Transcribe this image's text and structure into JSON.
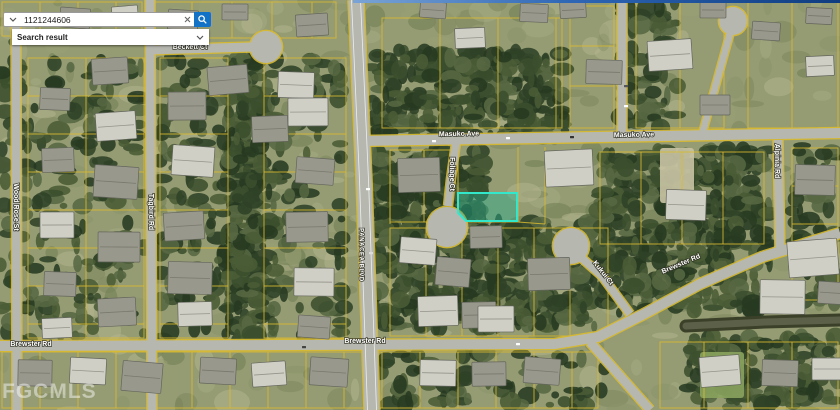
{
  "search": {
    "value": "1121244606",
    "result_label": "Search result",
    "button_color": "#1273c6"
  },
  "map": {
    "watermark": {
      "text": "FGCMLS",
      "x": 2,
      "y": 398,
      "size": 21
    },
    "colors": {
      "ground": "#959c73",
      "road": "#b6b8b0",
      "parcel_line": "#d9ba30",
      "highlight_fill": "rgba(34,178,148,0.42)",
      "highlight_stroke": "#33e8ca",
      "canal": "#3b4029",
      "canal_water": "#5d6048",
      "label_fill": "#ffffff",
      "label_halo": "rgba(45,45,32,0.85)"
    },
    "labels": [
      {
        "text": "Beckett Ct",
        "x": 190,
        "y": 47,
        "rot": 0
      },
      {
        "text": "Masuko Ave",
        "x": 459,
        "y": 134,
        "rot": -1
      },
      {
        "text": "Masuko Ave",
        "x": 634,
        "y": 135,
        "rot": -1
      },
      {
        "text": "Foliage Ct",
        "x": 452,
        "y": 174,
        "rot": 90
      },
      {
        "text": "Alpinia Rd",
        "x": 777,
        "y": 161,
        "rot": 90
      },
      {
        "text": "PANACEA BLVD",
        "x": 361,
        "y": 255,
        "rot": 90,
        "size": 6,
        "spacing": 0.6
      },
      {
        "text": "Wood Rose St",
        "x": 16,
        "y": 207,
        "rot": 90
      },
      {
        "text": "Tagbird Rd",
        "x": 151,
        "y": 212,
        "rot": 90
      },
      {
        "text": "Kukui Ct",
        "x": 603,
        "y": 273,
        "rot": 52
      },
      {
        "text": "Brewster Rd",
        "x": 31,
        "y": 344,
        "rot": 0
      },
      {
        "text": "Brewster Rd",
        "x": 365,
        "y": 341,
        "rot": 0
      },
      {
        "text": "Brewster Rd",
        "x": 681,
        "y": 264,
        "rot": -23
      }
    ],
    "highlight_parcel": {
      "points": "458,193 517,193 517,221 466,221 458,213"
    },
    "roads": [
      {
        "name": "panacea-blvd",
        "pts": [
          [
            356,
            0
          ],
          [
            364,
            180
          ],
          [
            372,
            410
          ]
        ],
        "w": 15,
        "stripes": true
      },
      {
        "name": "masuko-ave",
        "pts": [
          [
            360,
            141
          ],
          [
            840,
            133
          ]
        ],
        "w": 10
      },
      {
        "name": "beckett-ct",
        "pts": [
          [
            148,
            50
          ],
          [
            252,
            47
          ]
        ],
        "w": 9
      },
      {
        "name": "wood-rose-st",
        "pts": [
          [
            16,
            24
          ],
          [
            17,
            410
          ]
        ],
        "w": 9
      },
      {
        "name": "tagbird-rd",
        "pts": [
          [
            150,
            0
          ],
          [
            152,
            410
          ]
        ],
        "w": 9
      },
      {
        "name": "brewster-rd",
        "pts": [
          [
            0,
            346
          ],
          [
            555,
            344
          ],
          [
            598,
            337
          ],
          [
            642,
            315
          ],
          [
            700,
            284
          ],
          [
            762,
            257
          ],
          [
            840,
            233
          ]
        ],
        "w": 10
      },
      {
        "name": "brewster-south-leg",
        "pts": [
          [
            590,
            342
          ],
          [
            650,
            410
          ]
        ],
        "w": 9
      },
      {
        "name": "foliage-ct",
        "pts": [
          [
            456,
            143
          ],
          [
            451,
            178
          ],
          [
            448,
            206
          ]
        ],
        "w": 8
      },
      {
        "name": "kukui-ct",
        "pts": [
          [
            576,
            253
          ],
          [
            602,
            276
          ],
          [
            630,
            314
          ]
        ],
        "w": 8
      },
      {
        "name": "alpinia-rd",
        "pts": [
          [
            778,
            140
          ],
          [
            780,
            250
          ]
        ],
        "w": 9
      },
      {
        "name": "north-stub-rd",
        "pts": [
          [
            622,
            0
          ],
          [
            622,
            137
          ]
        ],
        "w": 9
      },
      {
        "name": "top-right-court",
        "pts": [
          [
            731,
            30
          ],
          [
            703,
            131
          ]
        ],
        "w": 7
      }
    ],
    "culdesacs": [
      {
        "x": 266,
        "y": 47,
        "r": 16
      },
      {
        "x": 447,
        "y": 227,
        "r": 20
      },
      {
        "x": 571,
        "y": 246,
        "r": 18
      },
      {
        "x": 733,
        "y": 21,
        "r": 14
      }
    ],
    "blocks": [
      {
        "x": 28,
        "y": 58,
        "w": 116,
        "h": 280,
        "dir": "h",
        "gap": 38,
        "mid": 1
      },
      {
        "x": 160,
        "y": 58,
        "w": 68,
        "h": 280,
        "dir": "h",
        "gap": 38
      },
      {
        "x": 264,
        "y": 58,
        "w": 82,
        "h": 280,
        "dir": "h",
        "gap": 38
      },
      {
        "x": 2,
        "y": 2,
        "w": 140,
        "h": 34,
        "dir": "v",
        "gap": 38
      },
      {
        "x": 152,
        "y": 2,
        "w": 184,
        "h": 36,
        "dir": "v",
        "gap": 40
      },
      {
        "x": 382,
        "y": 18,
        "w": 180,
        "h": 110,
        "dir": "v",
        "gap": 58
      },
      {
        "x": 570,
        "y": 6,
        "w": 44,
        "h": 122,
        "dir": "h",
        "gap": 40
      },
      {
        "x": 636,
        "y": 2,
        "w": 88,
        "h": 126,
        "dir": "v",
        "gap": 44
      },
      {
        "x": 748,
        "y": 2,
        "w": 90,
        "h": 126,
        "dir": "v",
        "gap": 44
      },
      {
        "x": 390,
        "y": 150,
        "w": 68,
        "h": 72,
        "dir": "v",
        "gap": 34
      },
      {
        "x": 600,
        "y": 152,
        "w": 164,
        "h": 92,
        "dir": "v",
        "gap": 41
      },
      {
        "x": 792,
        "y": 148,
        "w": 46,
        "h": 152,
        "dir": "h",
        "gap": 38
      },
      {
        "x": 390,
        "y": 228,
        "w": 218,
        "h": 108,
        "dir": "v",
        "gap": 36
      },
      {
        "x": 2,
        "y": 352,
        "w": 596,
        "h": 56,
        "dir": "v",
        "gap": 38
      },
      {
        "x": 660,
        "y": 342,
        "w": 178,
        "h": 66,
        "dir": "v",
        "gap": 44
      }
    ],
    "extra_lines": [
      [
        458,
        150,
        458,
        193
      ],
      [
        518,
        147,
        518,
        222
      ],
      [
        545,
        147,
        545,
        224
      ],
      [
        458,
        193,
        518,
        193
      ],
      [
        466,
        222,
        518,
        222
      ],
      [
        518,
        222,
        545,
        224
      ],
      [
        390,
        150,
        390,
        224
      ],
      [
        424,
        150,
        424,
        200
      ]
    ],
    "forest_zones": [
      {
        "x": 370,
        "y": 50,
        "w": 195,
        "h": 88,
        "d": 1
      },
      {
        "x": 228,
        "y": 56,
        "w": 36,
        "h": 286,
        "d": 1.5
      },
      {
        "x": 368,
        "y": 148,
        "w": 115,
        "h": 180,
        "d": 1
      },
      {
        "x": 480,
        "y": 222,
        "w": 115,
        "h": 105,
        "d": 1
      },
      {
        "x": 600,
        "y": 148,
        "w": 170,
        "h": 165,
        "d": 0.9
      },
      {
        "x": 688,
        "y": 336,
        "w": 150,
        "h": 72,
        "d": 0.8
      },
      {
        "x": 30,
        "y": 58,
        "w": 115,
        "h": 282,
        "d": 0.25
      },
      {
        "x": 160,
        "y": 58,
        "w": 68,
        "h": 282,
        "d": 0.3
      },
      {
        "x": 264,
        "y": 58,
        "w": 80,
        "h": 282,
        "d": 0.3
      },
      {
        "x": 380,
        "y": 352,
        "w": 225,
        "h": 56,
        "d": 0.3
      },
      {
        "x": 620,
        "y": 2,
        "w": 60,
        "h": 128,
        "d": 0.5
      },
      {
        "x": 790,
        "y": 145,
        "w": 50,
        "h": 158,
        "d": 0.4
      },
      {
        "x": 0,
        "y": 40,
        "w": 28,
        "h": 300,
        "d": 0.35
      }
    ],
    "light_patches": [
      {
        "x": 660,
        "y": 148,
        "w": 34,
        "h": 55,
        "c": "#c9c4a4"
      },
      {
        "x": 700,
        "y": 352,
        "w": 44,
        "h": 46,
        "c": "#8aa35e"
      }
    ],
    "canal_br": [
      [
        686,
        326
      ],
      [
        765,
        322
      ],
      [
        840,
        320
      ]
    ],
    "houses": [
      [
        60,
        8,
        30,
        20,
        0
      ],
      [
        112,
        6,
        26,
        17,
        1
      ],
      [
        168,
        10,
        30,
        20,
        0
      ],
      [
        222,
        4,
        26,
        16,
        0
      ],
      [
        296,
        14,
        32,
        22,
        0
      ],
      [
        420,
        2,
        26,
        16,
        0
      ],
      [
        455,
        28,
        30,
        20,
        1
      ],
      [
        520,
        4,
        28,
        18,
        0
      ],
      [
        560,
        2,
        26,
        16,
        0
      ],
      [
        648,
        40,
        44,
        30,
        1
      ],
      [
        700,
        2,
        26,
        16,
        0
      ],
      [
        752,
        22,
        28,
        18,
        0
      ],
      [
        806,
        8,
        26,
        16,
        0
      ],
      [
        806,
        56,
        28,
        20,
        1
      ],
      [
        92,
        58,
        36,
        26,
        0
      ],
      [
        40,
        88,
        30,
        22,
        0
      ],
      [
        96,
        112,
        40,
        28,
        1
      ],
      [
        42,
        148,
        32,
        24,
        0
      ],
      [
        94,
        166,
        44,
        32,
        0
      ],
      [
        40,
        212,
        34,
        26,
        1
      ],
      [
        98,
        232,
        42,
        30,
        0
      ],
      [
        44,
        272,
        32,
        24,
        0
      ],
      [
        98,
        298,
        38,
        28,
        0
      ],
      [
        42,
        318,
        30,
        20,
        1
      ],
      [
        168,
        92,
        38,
        28,
        0
      ],
      [
        172,
        146,
        42,
        30,
        1
      ],
      [
        164,
        212,
        40,
        28,
        0
      ],
      [
        168,
        262,
        44,
        32,
        0
      ],
      [
        178,
        302,
        34,
        24,
        1
      ],
      [
        208,
        66,
        40,
        28,
        0
      ],
      [
        278,
        72,
        36,
        26,
        1
      ],
      [
        252,
        116,
        36,
        26,
        0
      ],
      [
        288,
        98,
        40,
        28,
        1
      ],
      [
        296,
        158,
        38,
        26,
        0
      ],
      [
        286,
        212,
        42,
        30,
        0
      ],
      [
        294,
        268,
        40,
        28,
        1
      ],
      [
        298,
        316,
        32,
        22,
        0
      ],
      [
        398,
        158,
        42,
        34,
        0
      ],
      [
        400,
        238,
        36,
        26,
        1
      ],
      [
        470,
        226,
        32,
        22,
        0
      ],
      [
        436,
        258,
        34,
        28,
        0
      ],
      [
        418,
        296,
        40,
        30,
        1
      ],
      [
        462,
        302,
        34,
        26,
        0
      ],
      [
        545,
        150,
        48,
        36,
        1
      ],
      [
        528,
        258,
        42,
        32,
        0
      ],
      [
        478,
        306,
        36,
        26,
        1
      ],
      [
        666,
        190,
        40,
        30,
        1
      ],
      [
        700,
        95,
        30,
        20,
        0
      ],
      [
        586,
        60,
        36,
        24,
        0
      ],
      [
        760,
        280,
        45,
        34,
        1
      ],
      [
        795,
        165,
        40,
        30,
        0
      ],
      [
        788,
        240,
        50,
        36,
        1
      ],
      [
        818,
        282,
        30,
        22,
        0
      ],
      [
        18,
        360,
        34,
        26,
        0
      ],
      [
        70,
        358,
        36,
        26,
        1
      ],
      [
        122,
        362,
        40,
        30,
        0
      ],
      [
        200,
        358,
        36,
        26,
        0
      ],
      [
        252,
        362,
        34,
        24,
        1
      ],
      [
        310,
        358,
        38,
        28,
        0
      ],
      [
        420,
        360,
        36,
        26,
        1
      ],
      [
        472,
        362,
        34,
        24,
        0
      ],
      [
        524,
        358,
        36,
        26,
        0
      ],
      [
        700,
        356,
        40,
        30,
        1
      ],
      [
        762,
        360,
        36,
        26,
        0
      ],
      [
        812,
        358,
        30,
        22,
        1
      ]
    ],
    "vehicles": [
      [
        432,
        140,
        "#ffffff"
      ],
      [
        506,
        137,
        "#ffffff"
      ],
      [
        570,
        136,
        "#333333"
      ],
      [
        366,
        188,
        "#ffffff"
      ],
      [
        369,
        252,
        "#dddddd"
      ],
      [
        302,
        346,
        "#444444"
      ],
      [
        516,
        343,
        "#ffffff"
      ],
      [
        624,
        105,
        "#ffffff"
      ],
      [
        624,
        85,
        "#555555"
      ]
    ]
  }
}
